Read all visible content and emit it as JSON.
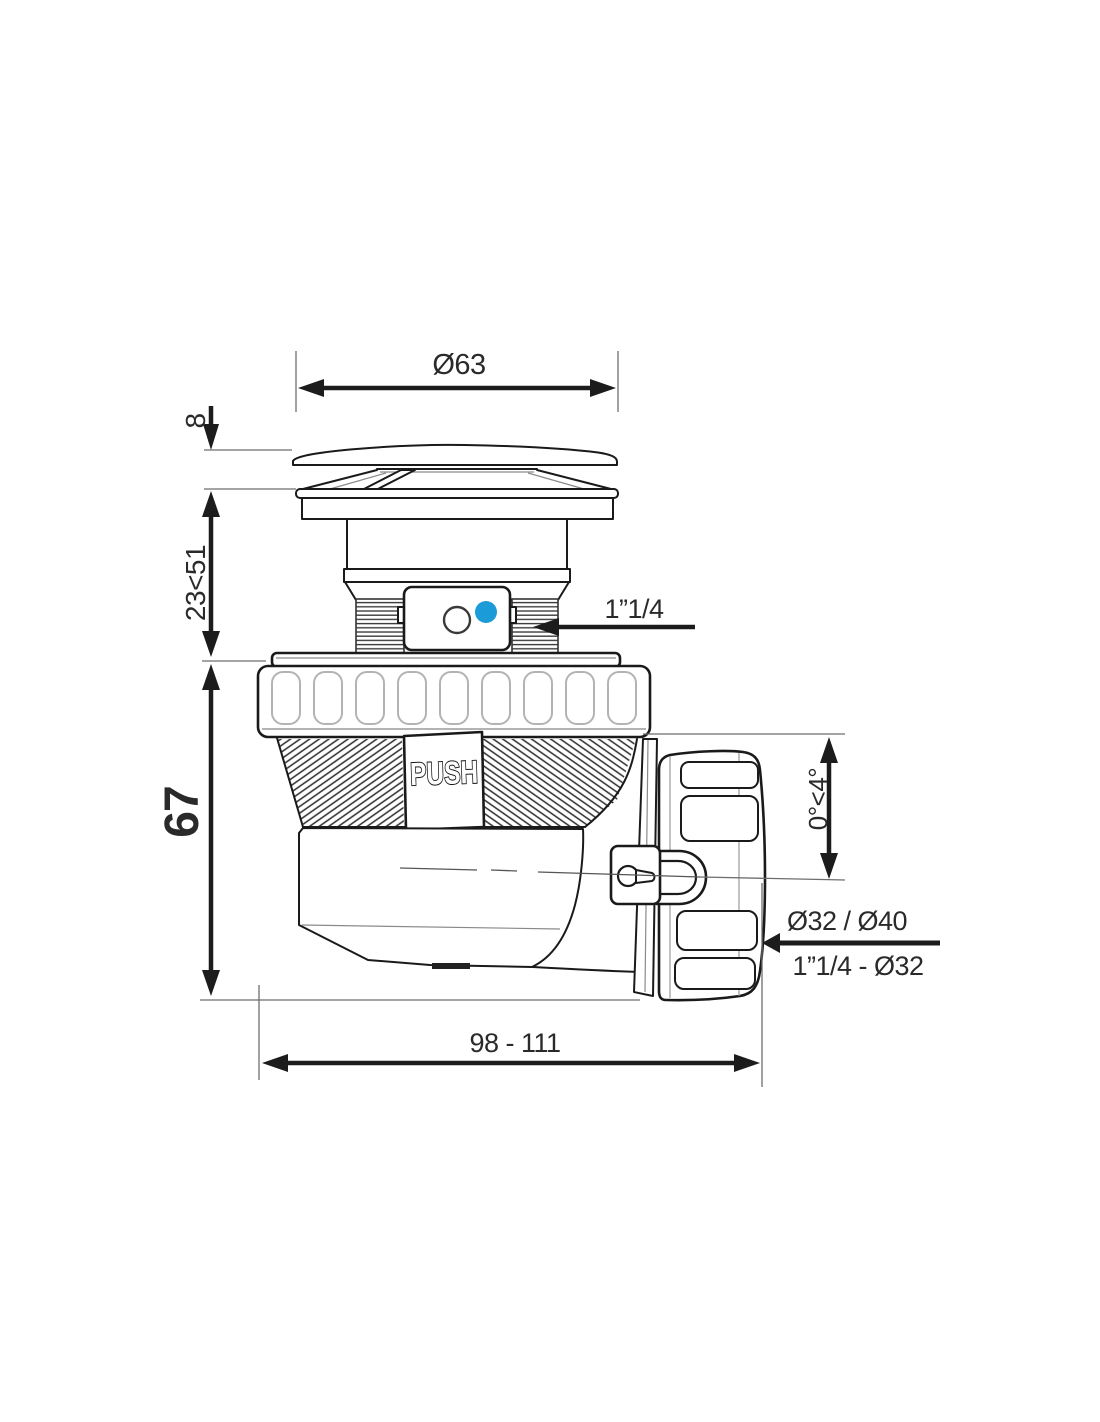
{
  "figure": {
    "title": "drain-trap-technical-drawing",
    "labels": {
      "push": "PUSH"
    },
    "dimensions": {
      "cap_diameter": "Ø63",
      "cap_height": "8",
      "adjustable_height": "23<51",
      "body_height": "67",
      "inlet_thread": "1”1/4",
      "outlet_angle": "0°<4°",
      "outlet_sizes": "Ø32 / Ø40",
      "outlet_thread": "1”1/4 - Ø32",
      "total_length": "98 - 111"
    },
    "colors": {
      "line": "#1a1a1a",
      "accent_blue": "#1b9cd8",
      "background": "#ffffff"
    }
  }
}
